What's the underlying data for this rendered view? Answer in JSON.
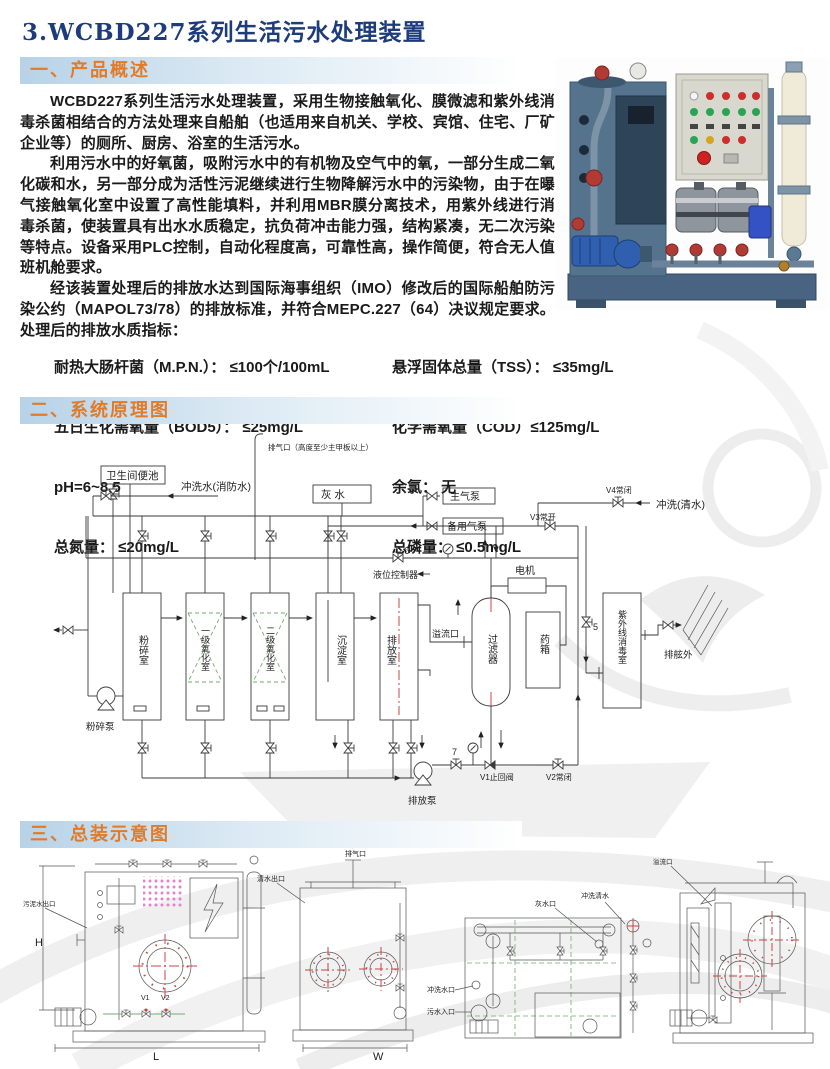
{
  "page_title": "3.WCBD227系列生活污水处理装置",
  "section1": {
    "heading": "一、产品概述",
    "para1": "WCBD227系列生活污水处理装置，采用生物接触氧化、膜微滤和紫外线消毒杀菌相结合的方法处理来自船舶（也适用来自机关、学校、宾馆、住宅、厂矿企业等）的厕所、厨房、浴室的生活污水。",
    "para2": "利用污水中的好氧菌，吸附污水中的有机物及空气中的氧，一部分生成二氧化碳和水，另一部分成为活性污泥继续进行生物降解污水中的污染物，由于在曝气接触氧化室中设置了高性能填料，并利用MBR膜分离技术，用紫外线进行消毒杀菌，使装置具有出水水质稳定，抗负荷冲击能力强，结构紧凑，无二次污染等特点。设备采用PLC控制，自动化程度高，可靠性高，操作简便，符合无人值班机舱要求。",
    "para3": "经该装置处理后的排放水达到国际海事组织（IMO）修改后的国际船舶防污染公约（MAPOL73/78）的排放标准，并符合MEPC.227（64）决议规定要求。处理后的排放水质指标：",
    "specs_left": [
      "耐热大肠杆菌（M.P.N.）： ≤100个/100mL",
      "五日生化需氧量（BOD5）： ≤25mg/L",
      "pH=6~8.5",
      "总氮量： ≤20mg/L"
    ],
    "specs_right": [
      "悬浮固体总量（TSS）： ≤35mg/L",
      "化学需氧量（COD）≤125mg/L",
      "余氯： 无",
      "总磷量： ≤0.5mg/L"
    ]
  },
  "section2": {
    "heading": "二、系统原理图",
    "labels": {
      "vent_outlet": "排气口（高度至少主甲板以上）",
      "toilet": "卫生间便池",
      "flush_fire_water": "冲洗水(消防水)",
      "gray_water": "灰  水",
      "main_air_pump": "主气泵",
      "backup_air_pump": "备用气泵",
      "valve_v4": "V4常闭",
      "valve_v3": "V3常开",
      "flush_clean_water": "冲洗(清水)",
      "level_controller": "液位控制器",
      "motor": "电机",
      "tank_crush": "粉碎室",
      "tank_oxid1": "一级氧化室",
      "tank_oxid2": "二级氧化室",
      "tank_settle": "沉淀室",
      "tank_discharge": "排放室",
      "overflow_port": "溢流口",
      "filter": "过滤器",
      "chemical_tank": "药箱",
      "uv_chamber": "紫外线消毒室",
      "overboard": "排舷外",
      "crush_pump": "粉碎泵",
      "discharge_pump": "排放泵",
      "valve_v1": "V1止回阀",
      "valve_v2": "V2常闭",
      "num5": "5",
      "num6": "6",
      "num7": "7"
    }
  },
  "section3": {
    "heading": "三、总装示意图",
    "front_view": {
      "sludge_outlet": "污泥水出口",
      "v1": "V1",
      "v2": "V2",
      "dim_h": "H",
      "dim_l": "L"
    },
    "side_view": {
      "clean_water_outlet": "清水出口",
      "vent": "排气口",
      "dim_w": "W"
    },
    "top_view": {
      "gray_water_port": "灰水口",
      "flush_clean": "冲洗清水",
      "flush_port": "冲洗水口",
      "sewage_inlet": "污水入口"
    },
    "rear_view": {
      "overflow": "溢流口"
    }
  }
}
